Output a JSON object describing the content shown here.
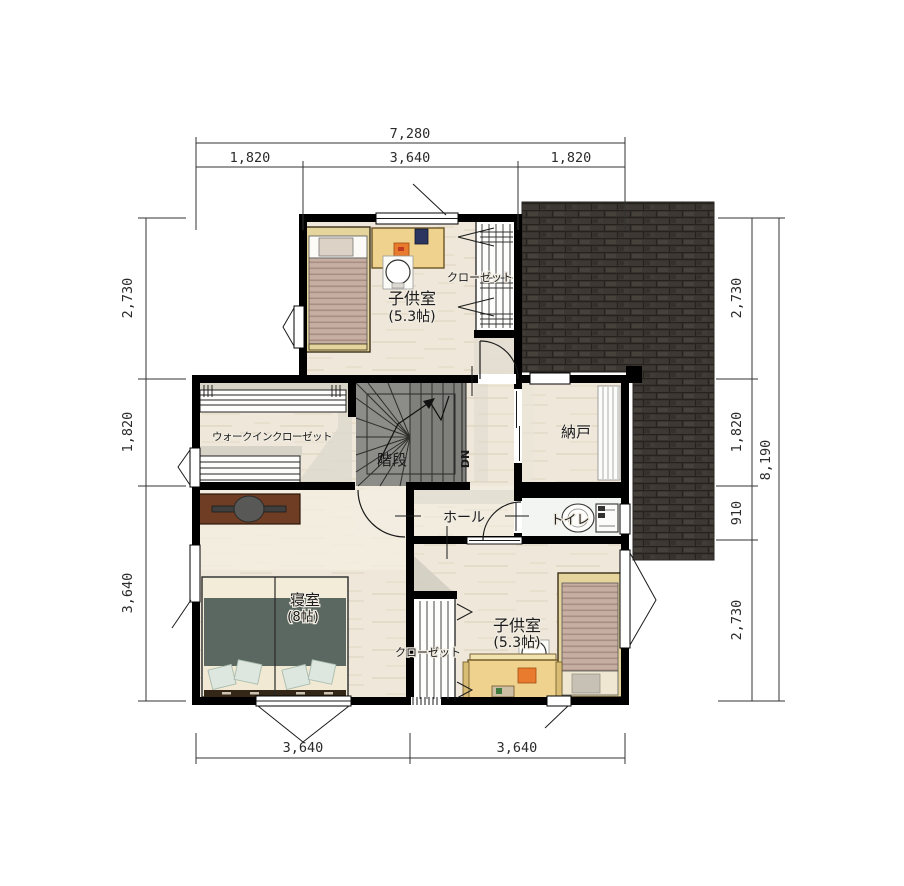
{
  "plan": {
    "rooms": {
      "child_room_top": {
        "name": "子供室",
        "size": "(5.3帖)"
      },
      "closet_top": {
        "name": "クローゼット"
      },
      "walk_in_closet": {
        "name": "ウォークインクローゼット"
      },
      "stairs": {
        "name": "階段",
        "direction": "DN"
      },
      "storage": {
        "name": "納戸"
      },
      "hall": {
        "name": "ホール"
      },
      "toilet": {
        "name": "トイレ"
      },
      "bedroom": {
        "name": "寝室",
        "size": "(8帖)"
      },
      "child_room_bottom": {
        "name": "子供室",
        "size": "(5.3帖)"
      },
      "closet_bottom": {
        "name": "クローゼット"
      }
    },
    "dimensions": {
      "top_total": "7,280",
      "top_segments": [
        "1,820",
        "3,640",
        "1,820"
      ],
      "bottom_segments": [
        "3,640",
        "3,640"
      ],
      "left_segments": [
        "2,730",
        "1,820",
        "3,640"
      ],
      "right_segments": [
        "2,730",
        "1,820",
        "910",
        "2,730"
      ],
      "right_total": "8,190"
    },
    "colors": {
      "wall": "#000000",
      "roof": "#3d3833",
      "floor_wood": "#efe8da",
      "desk": "#eed28e",
      "duvet": "#5b6862",
      "dresser": "#6e3d24"
    }
  }
}
